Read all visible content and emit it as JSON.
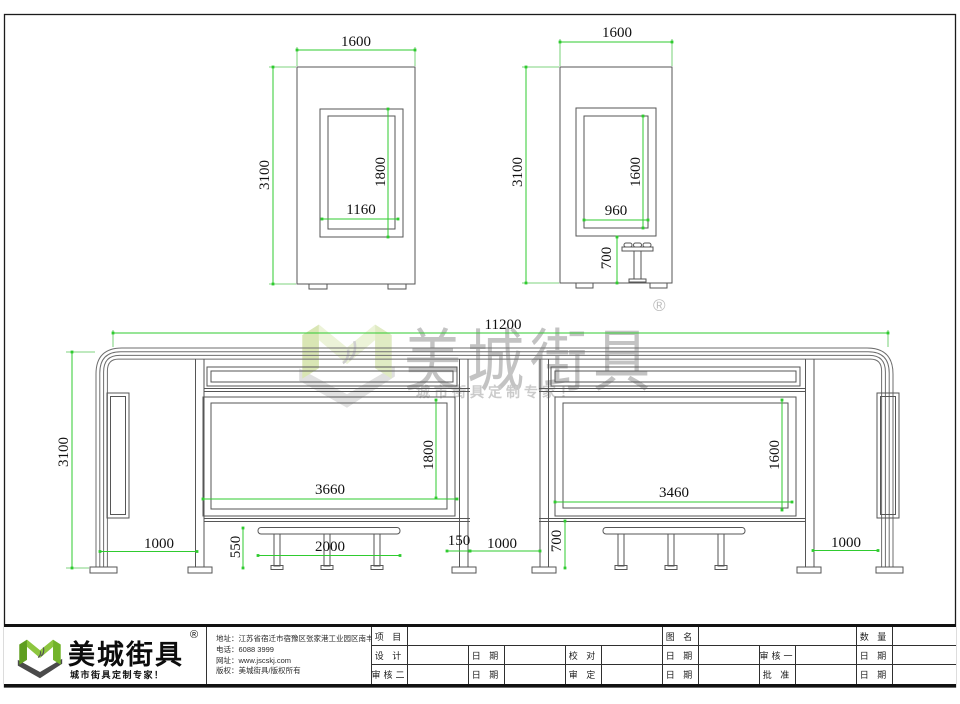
{
  "views": {
    "top_left": {
      "width": "1600",
      "height": "3100",
      "inner_height": "1800",
      "inner_width": "1160"
    },
    "top_right": {
      "width": "1600",
      "height": "3100",
      "inner_height": "1600",
      "inner_width": "960",
      "seat_height": "700"
    },
    "main": {
      "total_width": "11200",
      "height": "3100",
      "left_panel_width": "3660",
      "left_panel_height": "1800",
      "right_panel_width": "3460",
      "right_panel_height": "1600",
      "left_bay": "1000",
      "bench_height": "550",
      "bench_length": "2000",
      "panel_gap": "150",
      "center_bay": "1000",
      "board_bottom_height": "700",
      "right_bay": "1000"
    }
  },
  "watermark": {
    "brand": "美城街具",
    "reg": "®",
    "slogan": "城市街具定制专家！"
  },
  "footer": {
    "brand": "美城街具",
    "reg": "®",
    "slogan": "城市街具定制专家！",
    "address": "地址：江苏省宿迁市宿豫区张家港工业园区南丰路西侧1号",
    "phone": "电话：6088 3999",
    "website": "网址：www.jscskj.com",
    "copyright": "版权：美城街具/版权所有"
  },
  "titleblock": {
    "project": "项 目",
    "drawing_name": "图 名",
    "quantity": "数 量",
    "design": "设 计",
    "proofread": "校 对",
    "review1": "审核一",
    "review2": "审核二",
    "approve": "审 定",
    "ratify": "批 准",
    "date": "日 期"
  },
  "colors": {
    "dimension_green": "#2fcb2f",
    "line_gray": "#565656",
    "brand_green": "#8dc63f",
    "watermark_gray": "#c3c3c3"
  }
}
